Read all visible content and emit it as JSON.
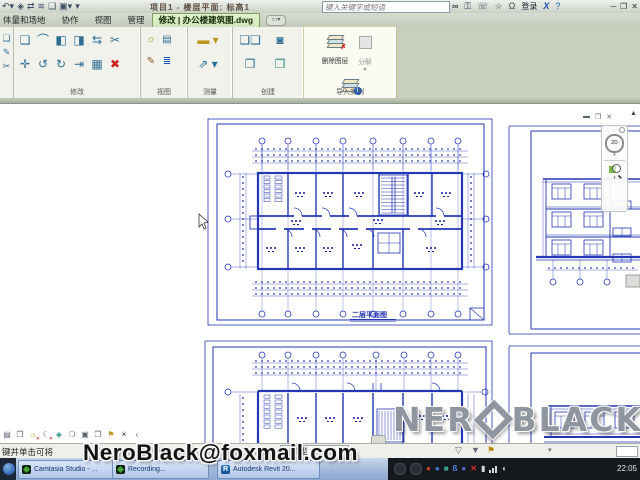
{
  "title_bar": {
    "title": "项目1 - 楼层平面: 标高1",
    "search_placeholder": "键入关键字或短语",
    "signin_label": "登录"
  },
  "ribbon": {
    "tabs": [
      "体量和场地",
      "协作",
      "视图",
      "管理"
    ],
    "active_tab": "修改 | 办公楼建筑图.dwg",
    "panel_labels": {
      "modify": "修改",
      "view": "视图",
      "measure": "测量",
      "create": "创建",
      "import_instance": "导入实例"
    },
    "import_instance_buttons": {
      "delete_layers": "删除图层",
      "explode": "分解",
      "query": "查询"
    }
  },
  "drawing": {
    "plan_title": "二层平面图",
    "nav_2d_label": "2D"
  },
  "status_bar": {
    "hint_text": "键并单击可将",
    "worker_count": ":0",
    "model_selector": "主模型"
  },
  "taskbar": {
    "buttons": [
      "Camtasia Studio - ...",
      "Recording...",
      "Autodesk Revit 20..."
    ],
    "time": "22:05"
  },
  "watermark": {
    "logo_left": "NER",
    "logo_right": "BLACK",
    "email": "NeroBlack@foxmail.com"
  },
  "colors": {
    "cad_blue": "#2437b5",
    "cad_dark_blue": "#0e1a96",
    "active_tab_green": "#d4e8c2"
  }
}
